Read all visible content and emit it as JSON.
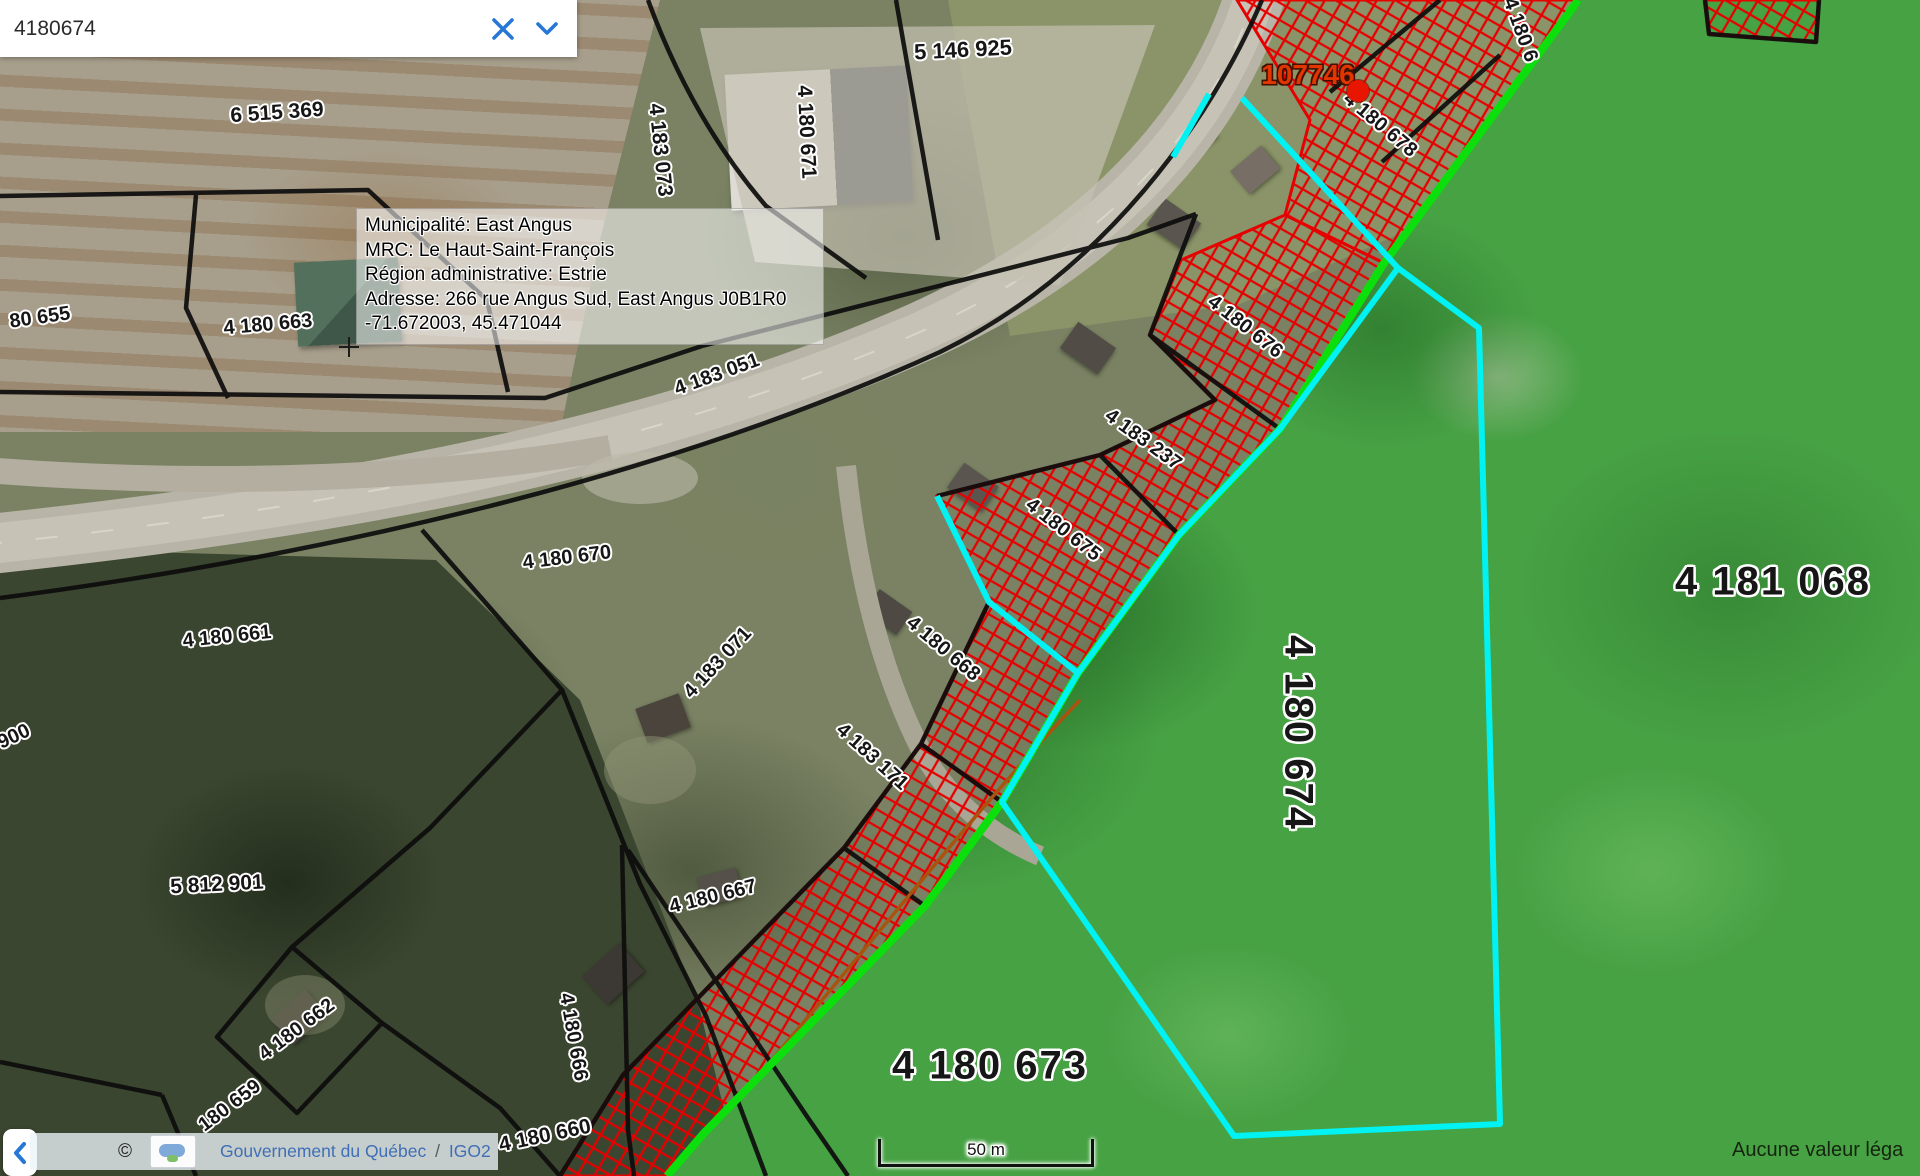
{
  "search_panel": {
    "value": "4180674",
    "clear_icon": "x-icon",
    "expand_icon": "chevron-down-icon",
    "accent_color": "#2677d6"
  },
  "tooltip": {
    "lines": [
      "Municipalité: East Angus",
      "MRC: Le Haut-Saint-François",
      "Région administrative: Estrie",
      "Adresse: 266 rue Angus Sud, East Angus J0B1R0",
      "-71.672003, 45.471044"
    ]
  },
  "marker": {
    "label": "107746",
    "color": "#e23500"
  },
  "parcel_labels": [
    {
      "text": "6 515 369",
      "x": 277,
      "y": 113,
      "rot": -4,
      "size": 21
    },
    {
      "text": "5 146 925",
      "x": 963,
      "y": 50,
      "rot": -3,
      "size": 22
    },
    {
      "text": "4 183 073",
      "x": 660,
      "y": 150,
      "rot": 84,
      "size": 21
    },
    {
      "text": "4 180 671",
      "x": 806,
      "y": 132,
      "rot": 87,
      "size": 21
    },
    {
      "text": "80 655",
      "x": 40,
      "y": 318,
      "rot": -8,
      "size": 20
    },
    {
      "text": "4 180 663",
      "x": 268,
      "y": 325,
      "rot": -5,
      "size": 20
    },
    {
      "text": "4 180 678",
      "x": 1380,
      "y": 125,
      "rot": 40,
      "size": 20
    },
    {
      "text": "4 180 6",
      "x": 1520,
      "y": 30,
      "rot": 70,
      "size": 20
    },
    {
      "text": "4 183 051",
      "x": 717,
      "y": 375,
      "rot": -20,
      "size": 20
    },
    {
      "text": "4 180 676",
      "x": 1245,
      "y": 327,
      "rot": 38,
      "size": 20
    },
    {
      "text": "4 183 237",
      "x": 1143,
      "y": 440,
      "rot": 36,
      "size": 20
    },
    {
      "text": "4 180 675",
      "x": 1063,
      "y": 530,
      "rot": 38,
      "size": 20
    },
    {
      "text": "4 180 670",
      "x": 567,
      "y": 558,
      "rot": -7,
      "size": 20
    },
    {
      "text": "4 180 661",
      "x": 227,
      "y": 637,
      "rot": -6,
      "size": 20
    },
    {
      "text": "4 183 071",
      "x": 718,
      "y": 663,
      "rot": -47,
      "size": 20
    },
    {
      "text": "4 180 668",
      "x": 943,
      "y": 649,
      "rot": 40,
      "size": 20
    },
    {
      "text": "4 183 171",
      "x": 872,
      "y": 757,
      "rot": 42,
      "size": 20
    },
    {
      "text": "900",
      "x": 14,
      "y": 737,
      "rot": -25,
      "size": 20
    },
    {
      "text": "4 181 068",
      "x": 1773,
      "y": 582,
      "rot": 0,
      "size": 40,
      "big": true
    },
    {
      "text": "4 180 674",
      "x": 1298,
      "y": 733,
      "rot": 90,
      "size": 40,
      "big": true
    },
    {
      "text": "5 812 901",
      "x": 217,
      "y": 885,
      "rot": -3,
      "size": 21
    },
    {
      "text": "4 180 667",
      "x": 713,
      "y": 897,
      "rot": -14,
      "size": 20
    },
    {
      "text": "4 180 666",
      "x": 573,
      "y": 1037,
      "rot": 80,
      "size": 20
    },
    {
      "text": "4 180 662",
      "x": 297,
      "y": 1030,
      "rot": -37,
      "size": 20
    },
    {
      "text": "180 659",
      "x": 230,
      "y": 1106,
      "rot": -37,
      "size": 20
    },
    {
      "text": "4 180 673",
      "x": 990,
      "y": 1066,
      "rot": 0,
      "size": 40,
      "big": true
    },
    {
      "text": "4 180 660",
      "x": 545,
      "y": 1136,
      "rot": -12,
      "size": 21
    }
  ],
  "footer": {
    "collapse_icon": "chevron-left-icon",
    "copyright": "©",
    "layer_icon": "image-placeholder-icon",
    "attribution_org": "Gouvernement du Québec",
    "attribution_sep": "/",
    "attribution_app": "IGO2",
    "scale_label": "50 m",
    "disclaimer": "Aucune valeur léga"
  },
  "colors": {
    "selection_outline_cyan": "#00f2f2",
    "measure_line_green": "#0ce00c",
    "hatch_red": "#e60000",
    "parcel_line_black": "#0d0d0d",
    "selected_fill_green": "#47a244"
  }
}
